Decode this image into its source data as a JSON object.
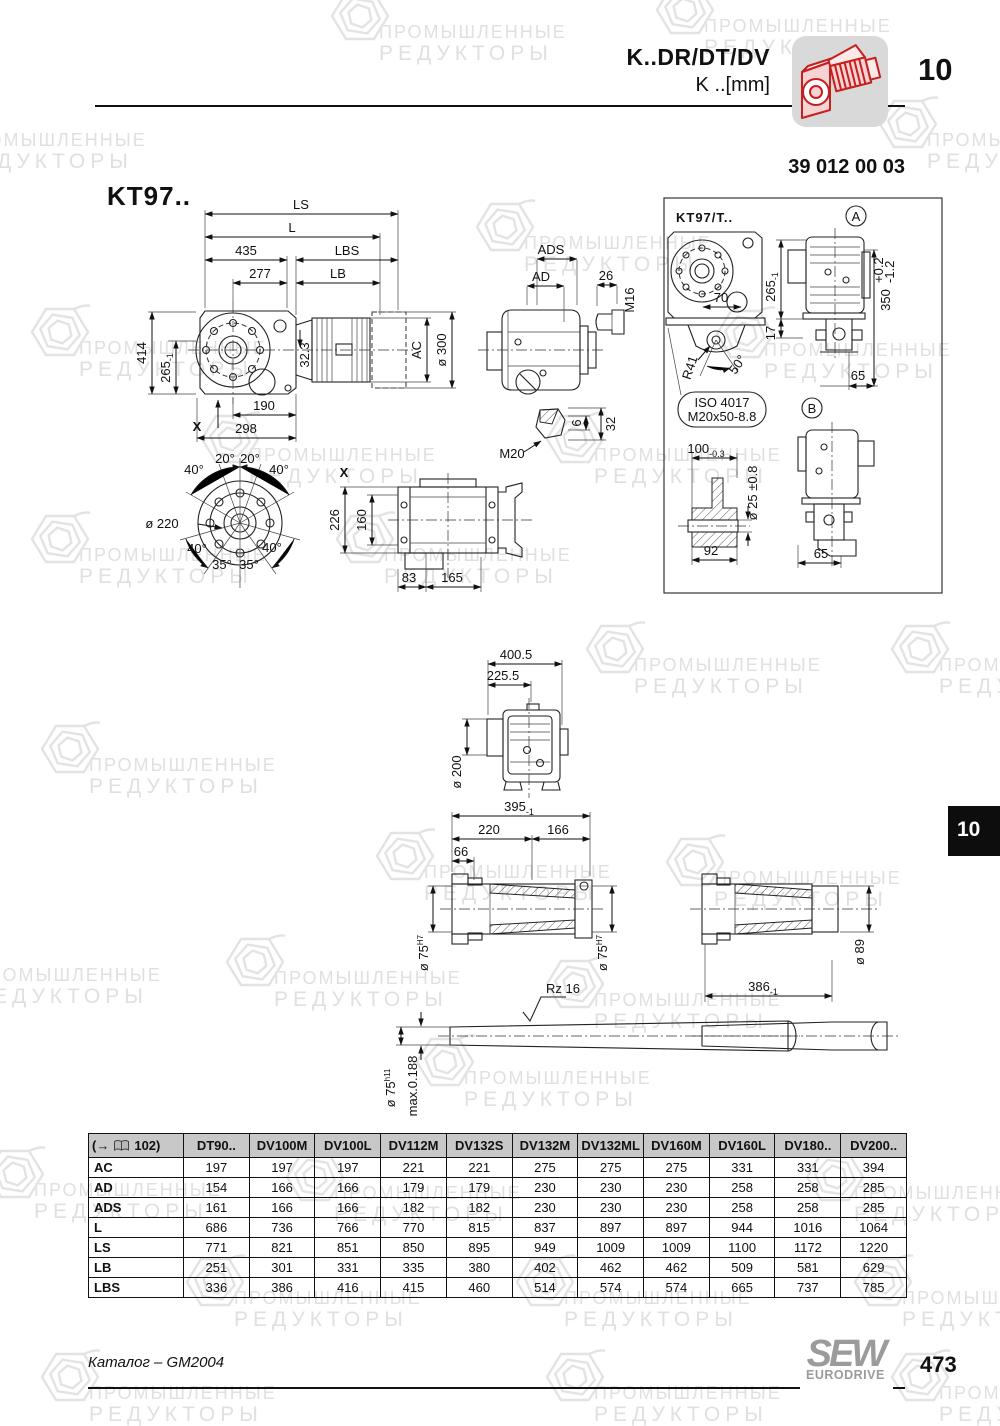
{
  "header": {
    "model": "K..DR/DT/DV",
    "unit_line": "K ..[mm]",
    "chapter": "10",
    "drawing_number": "39 012 00 03"
  },
  "watermark": {
    "line1": "ПРОМЫШЛЕННЫЕ",
    "line2": "РЕДУКТОРЫ"
  },
  "main_view": {
    "title": "KT97..",
    "ls": "LS",
    "l": "L",
    "d435": "435",
    "lbs": "LBS",
    "d277": "277",
    "lb": "LB",
    "d414": "414",
    "d265": "265",
    "d265_tol": "-1",
    "d190": "190",
    "d298": "298",
    "x_marker": "X",
    "d32_3": "32.3",
    "ac": "AC",
    "dia300": "ø 300"
  },
  "flange_view": {
    "dia220": "ø 220",
    "a40": "40°",
    "a20": "20°",
    "a35": "35°"
  },
  "x_view": {
    "label": "X",
    "d226": "226",
    "d160": "160",
    "d83": "83",
    "d165": "165"
  },
  "side_view": {
    "ads": "ADS",
    "ad": "AD",
    "d26": "26",
    "m16": "M16",
    "d32": "32",
    "d6": "6",
    "m20": "M20"
  },
  "t_view": {
    "title": "KT97/T..",
    "detail_a": "A",
    "detail_b": "B",
    "d70": "70",
    "d265": "265",
    "d265_tol": "-1",
    "d17": "17",
    "d350": "350",
    "d350_tol_up": "+0.2",
    "d350_tol_dn": "-1.2",
    "d65": "65",
    "r41": "R41",
    "a50": "50°",
    "iso_line1": "ISO 4017",
    "iso_line2": "M20x50-8.8",
    "d100": "100",
    "d100_tol": "-0.3",
    "dia25": "ø 25 ±0.8",
    "d92": "92",
    "d65b": "65"
  },
  "mid_view": {
    "d400": "400.5",
    "d225": "225.5",
    "dia200": "ø 200"
  },
  "shaft_view": {
    "d395": "395",
    "d395_tol": "-1",
    "d220": "220",
    "d166": "166",
    "d66": "66",
    "dia75": "ø 75",
    "h7": "H7",
    "rz": "Rz 16",
    "dia75b": "ø 75",
    "h11": "h11",
    "runout": "max.0.188",
    "dia89": "ø 89",
    "d386": "386",
    "d386_tol": "-1"
  },
  "table": {
    "ref_open": "(→",
    "ref_close": "102)",
    "columns": [
      "DT90..",
      "DV100M",
      "DV100L",
      "DV112M",
      "DV132S",
      "DV132M",
      "DV132ML",
      "DV160M",
      "DV160L",
      "DV180..",
      "DV200.."
    ],
    "rows": [
      {
        "label": "AC",
        "values": [
          "197",
          "197",
          "197",
          "221",
          "221",
          "275",
          "275",
          "275",
          "331",
          "331",
          "394"
        ]
      },
      {
        "label": "AD",
        "values": [
          "154",
          "166",
          "166",
          "179",
          "179",
          "230",
          "230",
          "230",
          "258",
          "258",
          "285"
        ]
      },
      {
        "label": "ADS",
        "values": [
          "161",
          "166",
          "166",
          "182",
          "182",
          "230",
          "230",
          "230",
          "258",
          "258",
          "285"
        ]
      },
      {
        "label": "L",
        "values": [
          "686",
          "736",
          "766",
          "770",
          "815",
          "837",
          "897",
          "897",
          "944",
          "1016",
          "1064"
        ]
      },
      {
        "label": "LS",
        "values": [
          "771",
          "821",
          "851",
          "850",
          "895",
          "949",
          "1009",
          "1009",
          "1100",
          "1172",
          "1220"
        ]
      },
      {
        "label": "LB",
        "values": [
          "251",
          "301",
          "331",
          "335",
          "380",
          "402",
          "462",
          "462",
          "509",
          "581",
          "629"
        ]
      },
      {
        "label": "LBS",
        "values": [
          "336",
          "386",
          "416",
          "415",
          "460",
          "514",
          "574",
          "574",
          "665",
          "737",
          "785"
        ]
      }
    ]
  },
  "side_tab": {
    "label": "10"
  },
  "footer": {
    "catalog": "Каталог – GM2004",
    "brand_top": "SEW",
    "brand_sub": "EURODRIVE",
    "page": "473"
  }
}
